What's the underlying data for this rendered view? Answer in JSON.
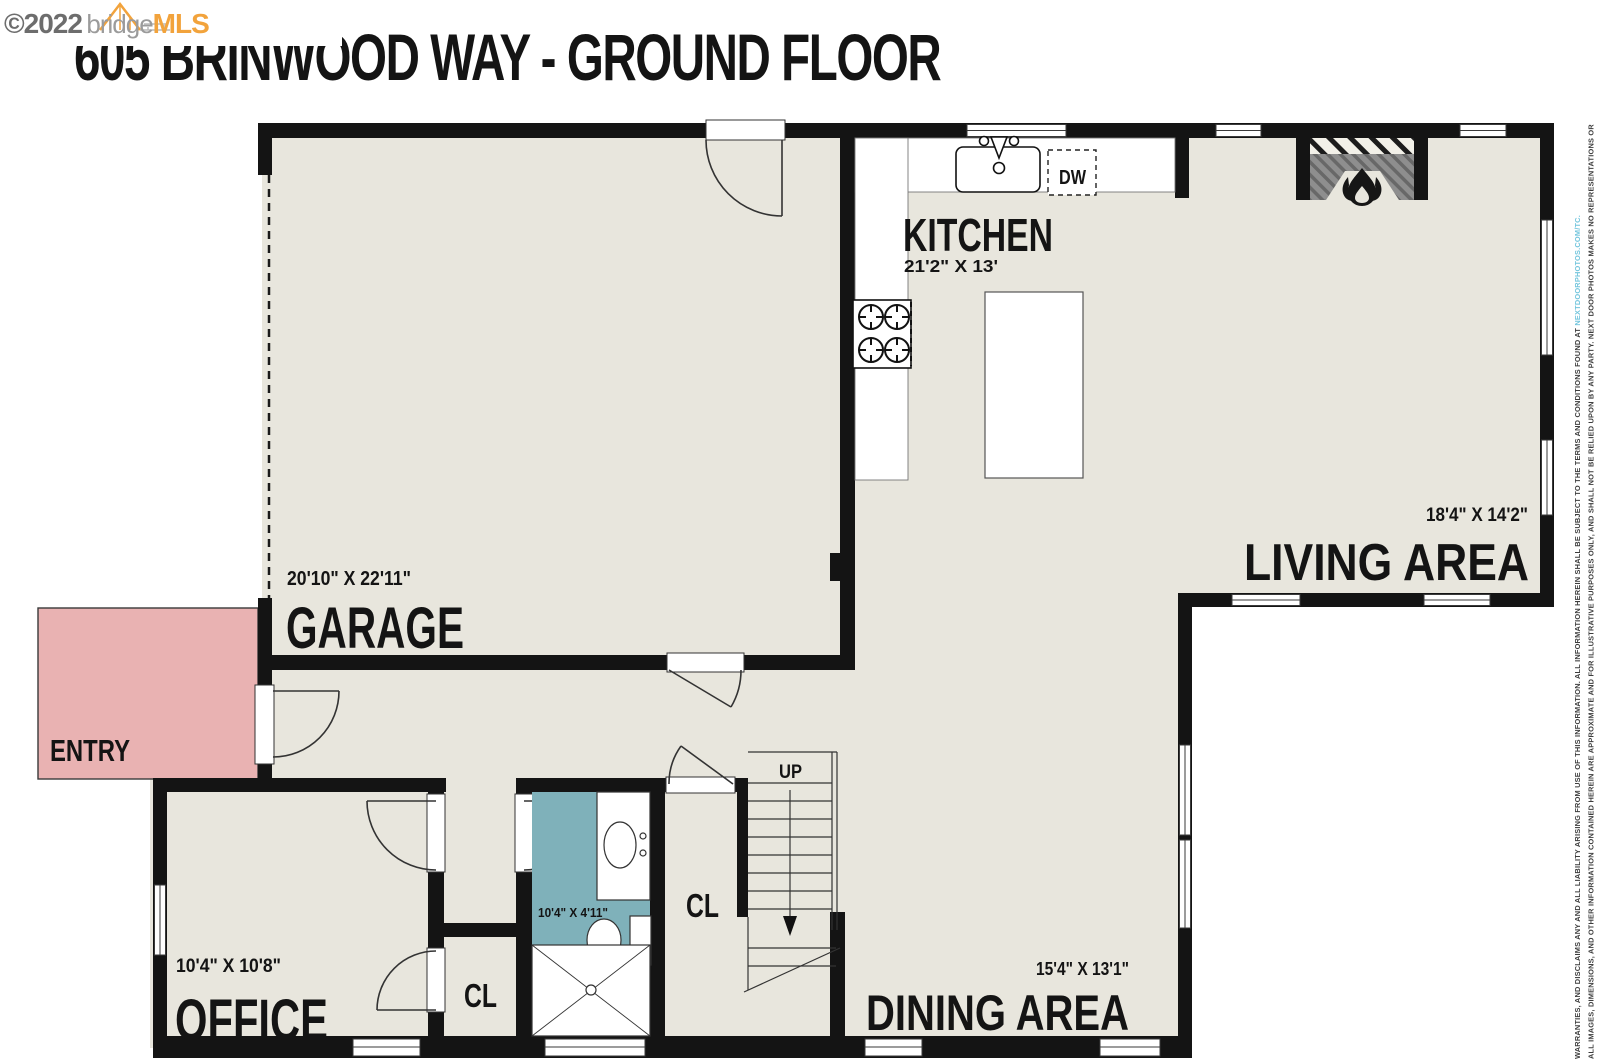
{
  "watermark": {
    "copyright": "©2022",
    "brand_gray": "bridge",
    "brand_orange": "MLS"
  },
  "title": "605 BRINWOOD WAY - GROUND FLOOR",
  "rooms": {
    "garage": {
      "name": "GARAGE",
      "dimensions": "20'10\" X 22'11\""
    },
    "kitchen": {
      "name": "KITCHEN",
      "dimensions": "21'2\" X 13'"
    },
    "living_area": {
      "name": "LIVING AREA",
      "dimensions": "18'4\" X 14'2\""
    },
    "dining_area": {
      "name": "DINING AREA",
      "dimensions": "15'4\" X 13'1\""
    },
    "office": {
      "name": "OFFICE",
      "dimensions": "10'4\" X 10'8\""
    },
    "bathroom": {
      "dimensions": "10'4\" X 4'11\""
    },
    "entry": {
      "name": "ENTRY"
    },
    "office_closet": {
      "label": "CL"
    },
    "hall_closet": {
      "label": "CL"
    }
  },
  "labels": {
    "stairs_up": "UP",
    "dishwasher": "DW"
  },
  "disclaimer": {
    "line1": "ALL IMAGES, DIMENSIONS, AND OTHER INFORMATION CONTAINED HEREIN ARE APPROXIMATE AND FOR ILLUSTRATIVE PURPOSES ONLY, AND SHALL NOT BE RELIED UPON BY ANY PARTY. NEXT DOOR PHOTOS MAKES NO REPRESENTATIONS OR",
    "line2": "WARRANTIES, AND DISCLAIMS ANY AND ALL LIABILITY ARISING FROM USE OF THIS INFORMATION. ALL INFORMATION HEREIN SHALL BE SUBJECT TO THE TERMS AND CONDITIONS FOUND AT ",
    "link": "NEXTDOORPHOTOS.COM/TC."
  },
  "colors": {
    "floor": "#e8e6dd",
    "wall": "#141414",
    "entry_fill": "#e9b2b2",
    "bathroom_fill": "#7fb1ba",
    "brand_orange": "#f2a33c",
    "link_blue": "#72c5dd"
  }
}
